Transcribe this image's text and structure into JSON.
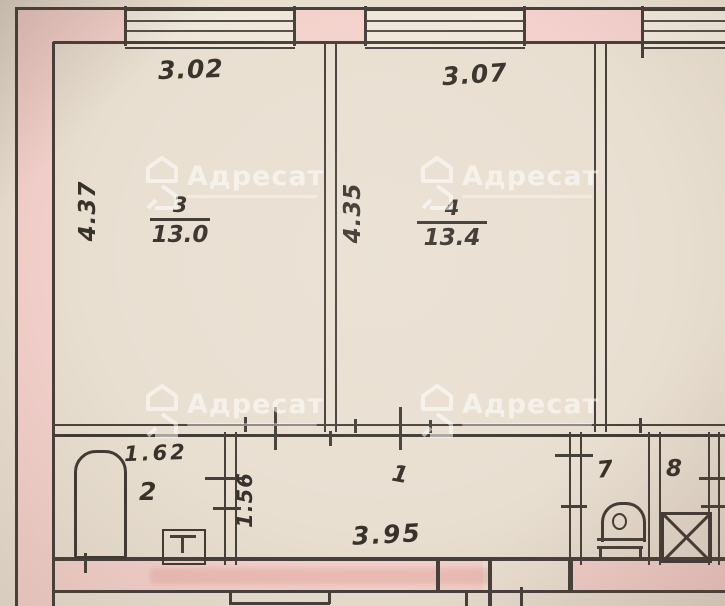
{
  "document": {
    "type": "apartment-floor-plan-scan"
  },
  "watermark": {
    "brand": "Адресат",
    "logo": "house-icon"
  },
  "colors": {
    "paper": "#e9dfd1",
    "wall_fill_pink": "#f4d1cc",
    "ink": "#46403a",
    "handwriting": "#37322b",
    "watermark_white": "#ffffff"
  },
  "icons": {
    "fixtures": [
      "bathtub-icon",
      "sink-icon",
      "toilet-icon",
      "vent-box-icon"
    ],
    "watermark_logo": "house-icon"
  },
  "labels": {
    "dim_top_left": "3.02",
    "dim_top_right": "3.07",
    "dim_left_height": "4.37",
    "dim_mid_height": "4.35",
    "room3": {
      "num": "3",
      "area": "13.0"
    },
    "room4": {
      "num": "4",
      "area": "13.4"
    },
    "room2": {
      "num": "2",
      "dim_width": "1.62"
    },
    "room1": {
      "num": "1",
      "dim_width": "3.95",
      "dim_height": "1.56"
    },
    "room7": {
      "num": "7"
    },
    "room8": {
      "num": "8"
    }
  }
}
